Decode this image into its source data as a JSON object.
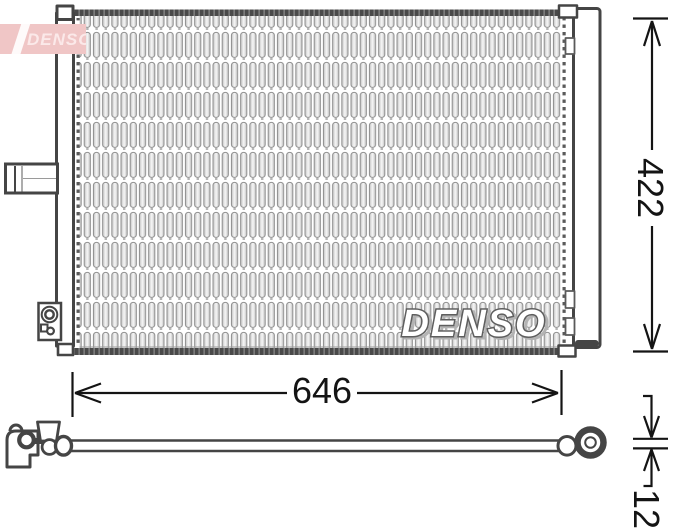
{
  "brand": "DENSO",
  "watermark": "DENSO",
  "dimensions": {
    "width": "646",
    "height": "422",
    "pipe_diameter": "12"
  },
  "colors": {
    "logo_bg": "#f0c6c6",
    "logo_text": "#fbe9e9",
    "outline": "#454545",
    "dimension_ink": "#141414",
    "core_line": "#8f8f8f"
  }
}
